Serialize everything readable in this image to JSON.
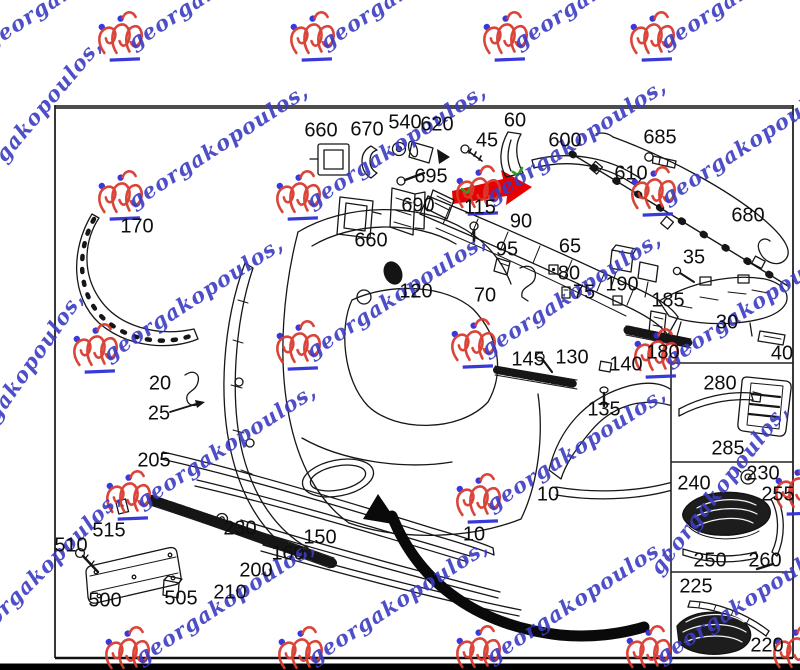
{
  "diagram": {
    "description": "Front bumper exploded parts diagram",
    "label_color": "#0e0e0e",
    "line_color": "#161616",
    "part_labels": [
      {
        "text": "660",
        "x": 321,
        "y": 131
      },
      {
        "text": "670",
        "x": 367,
        "y": 130
      },
      {
        "text": "540",
        "x": 405,
        "y": 123
      },
      {
        "text": "620",
        "x": 437,
        "y": 125
      },
      {
        "text": "60",
        "x": 515,
        "y": 121
      },
      {
        "text": "45",
        "x": 487,
        "y": 141
      },
      {
        "text": "600",
        "x": 565,
        "y": 141
      },
      {
        "text": "685",
        "x": 660,
        "y": 138
      },
      {
        "text": "610",
        "x": 631,
        "y": 174
      },
      {
        "text": "680",
        "x": 748,
        "y": 216
      },
      {
        "text": "695",
        "x": 431,
        "y": 177
      },
      {
        "text": "690",
        "x": 418,
        "y": 206
      },
      {
        "text": "115",
        "x": 480,
        "y": 208
      },
      {
        "text": "660",
        "x": 371,
        "y": 241
      },
      {
        "text": "170",
        "x": 137,
        "y": 227
      },
      {
        "text": "90",
        "x": 521,
        "y": 222
      },
      {
        "text": "95",
        "x": 507,
        "y": 250
      },
      {
        "text": "65",
        "x": 570,
        "y": 247
      },
      {
        "text": "80",
        "x": 569,
        "y": 274
      },
      {
        "text": "75",
        "x": 584,
        "y": 293
      },
      {
        "text": "190",
        "x": 622,
        "y": 285
      },
      {
        "text": "185",
        "x": 668,
        "y": 301
      },
      {
        "text": "35",
        "x": 694,
        "y": 258
      },
      {
        "text": "30",
        "x": 727,
        "y": 323
      },
      {
        "text": "40",
        "x": 782,
        "y": 354
      },
      {
        "text": "120",
        "x": 416,
        "y": 292
      },
      {
        "text": "70",
        "x": 485,
        "y": 296
      },
      {
        "text": "145",
        "x": 528,
        "y": 360
      },
      {
        "text": "130",
        "x": 572,
        "y": 358
      },
      {
        "text": "140",
        "x": 626,
        "y": 365
      },
      {
        "text": "135",
        "x": 604,
        "y": 410
      },
      {
        "text": "180",
        "x": 663,
        "y": 353
      },
      {
        "text": "20",
        "x": 160,
        "y": 384
      },
      {
        "text": "25",
        "x": 159,
        "y": 414
      },
      {
        "text": "205",
        "x": 154,
        "y": 461
      },
      {
        "text": "230",
        "x": 240,
        "y": 529
      },
      {
        "text": "515",
        "x": 109,
        "y": 531
      },
      {
        "text": "510",
        "x": 71,
        "y": 546
      },
      {
        "text": "500",
        "x": 105,
        "y": 601
      },
      {
        "text": "505",
        "x": 181,
        "y": 599
      },
      {
        "text": "210",
        "x": 230,
        "y": 593
      },
      {
        "text": "200",
        "x": 256,
        "y": 571
      },
      {
        "text": "160",
        "x": 288,
        "y": 554
      },
      {
        "text": "150",
        "x": 320,
        "y": 538
      },
      {
        "text": "10",
        "x": 548,
        "y": 495
      },
      {
        "text": "10",
        "x": 474,
        "y": 535
      },
      {
        "text": "280",
        "x": 720,
        "y": 384
      },
      {
        "text": "285",
        "x": 728,
        "y": 449
      },
      {
        "text": "230",
        "x": 763,
        "y": 474
      },
      {
        "text": "240",
        "x": 694,
        "y": 484
      },
      {
        "text": "255",
        "x": 778,
        "y": 495
      },
      {
        "text": "250",
        "x": 710,
        "y": 561
      },
      {
        "text": "260",
        "x": 765,
        "y": 561
      },
      {
        "text": "225",
        "x": 696,
        "y": 587
      },
      {
        "text": "220",
        "x": 767,
        "y": 646
      }
    ],
    "highlight": {
      "arrow_color": "#e60000",
      "check_color": "#2e9e1e"
    },
    "watermark": {
      "text": "georgakopoulos,",
      "text_color": "#3b3bc4",
      "logo_color": "#d93a2f",
      "dot_color": "#2f2fd9",
      "stamps": [
        {
          "x": 120,
          "y": 38
        },
        {
          "x": 312,
          "y": 38
        },
        {
          "x": 505,
          "y": 38
        },
        {
          "x": 652,
          "y": 38
        },
        {
          "x": 120,
          "y": 197
        },
        {
          "x": 298,
          "y": 197
        },
        {
          "x": 478,
          "y": 192
        },
        {
          "x": 653,
          "y": 193
        },
        {
          "x": 95,
          "y": 350
        },
        {
          "x": 298,
          "y": 347
        },
        {
          "x": 473,
          "y": 345
        },
        {
          "x": 656,
          "y": 355
        },
        {
          "x": 128,
          "y": 497
        },
        {
          "x": 478,
          "y": 500
        },
        {
          "x": 797,
          "y": 492
        },
        {
          "x": 127,
          "y": 653
        },
        {
          "x": 300,
          "y": 653
        },
        {
          "x": 478,
          "y": 652
        },
        {
          "x": 648,
          "y": 652
        },
        {
          "x": 795,
          "y": 652
        }
      ],
      "edge_texts": [
        {
          "x": -10,
          "y": 50,
          "rot": -33
        },
        {
          "x": -32,
          "y": 207,
          "rot": -50
        },
        {
          "x": -36,
          "y": 470,
          "rot": -55
        },
        {
          "x": -26,
          "y": 648,
          "rot": -45
        },
        {
          "x": 660,
          "y": 576,
          "rot": -52
        }
      ]
    }
  }
}
